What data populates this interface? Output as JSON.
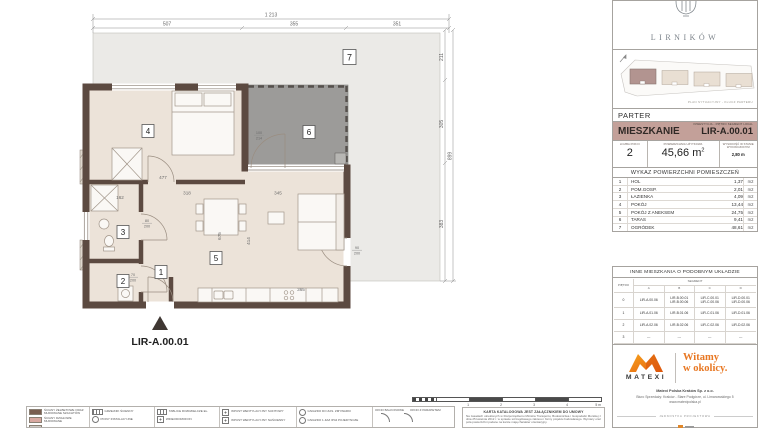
{
  "colors": {
    "wall_brown": "#5c4a41",
    "room_fill": "#ece3d9",
    "terrace_gray": "#9c9b99",
    "garden_gray": "#ebeae7",
    "band_mauve": "#c3a099",
    "matexi_orange": "#e87722",
    "highlight_block": "#b29490"
  },
  "plan": {
    "entrance_unit_label": "LIR-A.00.01",
    "rooms": {
      "r1": "1",
      "r2": "2",
      "r3": "3",
      "r4": "4",
      "r5": "5",
      "r6": "6",
      "r7": "7"
    },
    "dims": {
      "top_total": "1 213",
      "top_seg_1": "507",
      "top_seg_2": "355",
      "top_seg_3": "351",
      "right_seg_1": "211",
      "right_seg_2": "305",
      "right_seg_3": "383",
      "right_total": "899",
      "int_477": "477",
      "int_318": "318",
      "int_345": "345",
      "int_365": "365",
      "int_162": "162",
      "int_675": "675",
      "int_414": "414",
      "door_a_w": "100",
      "door_a_h": "214",
      "door_b_w": "80",
      "door_b_h": "200",
      "door_c_w": "70",
      "door_c_h": "200",
      "door_d_w": "90",
      "door_d_h": "200"
    }
  },
  "legend": {
    "col1a": "ŚCIANY ŻELBETOWE ORAZ MUROWANE SZACHTÓW",
    "col1b": "ŚCIANY DZIAŁOWE MUROWANE",
    "col2a": "GRZEJNIK ŚCIENNY",
    "col2b": "PIONY INSTALACYJNE",
    "col3a": "TABLICE ROZDZIELCZE EL.",
    "col3b": "WIDEODOMOFON",
    "col4a": "WPUST WENTYLACYJNY SUFITOWY",
    "col4b": "WPUST WENTYLACYJNY NAŚCIENNY",
    "col5a": "GNIAZDO DO ZAS. ZMYWARKI",
    "col5b": "GNIAZDO 1-FAZ IP44 POJEDYNCZE",
    "col6a": "OKNO BALKONOWE",
    "col6b": "OKNO Z PARAPETEM"
  },
  "scalebar": {
    "t1": "1",
    "t2": "2",
    "t3": "3",
    "t4": "4",
    "t5": "5 m"
  },
  "disclaimer": {
    "title": "KARTA KATALOGOWA JEST ZAŁĄCZNIKIEM DO UMOWY",
    "body": "Na zasadach określonych w Rozporządzeniu Ministra Transportu, Budownictwa i Gospodarki Morskiej z dnia 25 kwietnia 2012 r. w sprawie szczegółowego zakresu i formy projektu budowlanego. Wymiary oraz pola powierzchni podane na karcie mają charakter orientacyjny."
  },
  "panel": {
    "brand": "LIRNIKÓW",
    "site_caption": "PLAN SYTUACYJNY - KLUCZ PARTERU",
    "floor_label": "PARTER",
    "unit": {
      "section_label": "MIESZKANIE",
      "code_caption": "INWESTYCJA - PIĘTRO SEGMENT LOKAL",
      "code": "LIR-A.00.01"
    },
    "stats": {
      "rooms_label": "LICZBA POKOI",
      "rooms_value": "2",
      "area_label": "POWIERZCHNIA UŻYTKOWA",
      "area_value": "45,66",
      "area_unit_base": "m",
      "area_unit_sup": "2",
      "height_label": "WYSOKOŚĆ W STANIE WYKOŃCZONYM",
      "height_value": "2,80 m"
    },
    "rooms_table": {
      "title": "WYKAZ POWIERZCHNI POMIESZCZEŃ",
      "unit": "m2",
      "rows": [
        {
          "no": "1",
          "name": "HOL",
          "area": "1,37"
        },
        {
          "no": "2",
          "name": "POM.GOSP.",
          "area": "2,01"
        },
        {
          "no": "3",
          "name": "ŁAZIENKA",
          "area": "4,09"
        },
        {
          "no": "4",
          "name": "POKÓJ",
          "area": "13,44"
        },
        {
          "no": "5",
          "name": "POKÓJ Z ANEKSEM",
          "area": "24,75"
        },
        {
          "no": "6",
          "name": "TARAS",
          "area": "9,41"
        },
        {
          "no": "7",
          "name": "OGRÓDEK",
          "area": "48,61"
        }
      ]
    },
    "similar_table": {
      "title": "INNE MIESZKANIA O PODOBNYM UKŁADZIE",
      "segment_label": "SEGMENT",
      "floor_col": "PIĘTRO",
      "col_a": "A",
      "col_b": "B",
      "col_c": "C",
      "col_d": "D",
      "rows": [
        {
          "floor": "0",
          "a": "LIR-A.00.06",
          "b": "LIR-B.00.01\nLIR-B.00.06",
          "c": "LIR-C.00.01\nLIR-C.00.06",
          "d": "LIR-D.00.01\nLIR-D.00.06"
        },
        {
          "floor": "1",
          "a": "LIR-A.01.06",
          "b": "LIR-B.01.06",
          "c": "LIR-C.01.06",
          "d": "LIR-D.01.06"
        },
        {
          "floor": "2",
          "a": "LIR-A.02.06",
          "b": "LIR-B.02.06",
          "c": "LIR-C.02.06",
          "d": "LIR-D.02.06"
        },
        {
          "floor": "3",
          "a": "---",
          "b": "---",
          "c": "---",
          "d": "---"
        }
      ]
    },
    "footer": {
      "brand": "MATEXI",
      "tagline_line1": "Witamy",
      "tagline_line2": "w okolicy.",
      "company": "Matexi Polska Kraków Sp. z o.o.",
      "address": "Biuro Sprzedaży: Kraków - Stare Podgórze, ul. Limanowskiego 5",
      "website": "www.matexipolska.pl",
      "design_label": "JEDNOSTKA PROJEKTOWA"
    }
  }
}
